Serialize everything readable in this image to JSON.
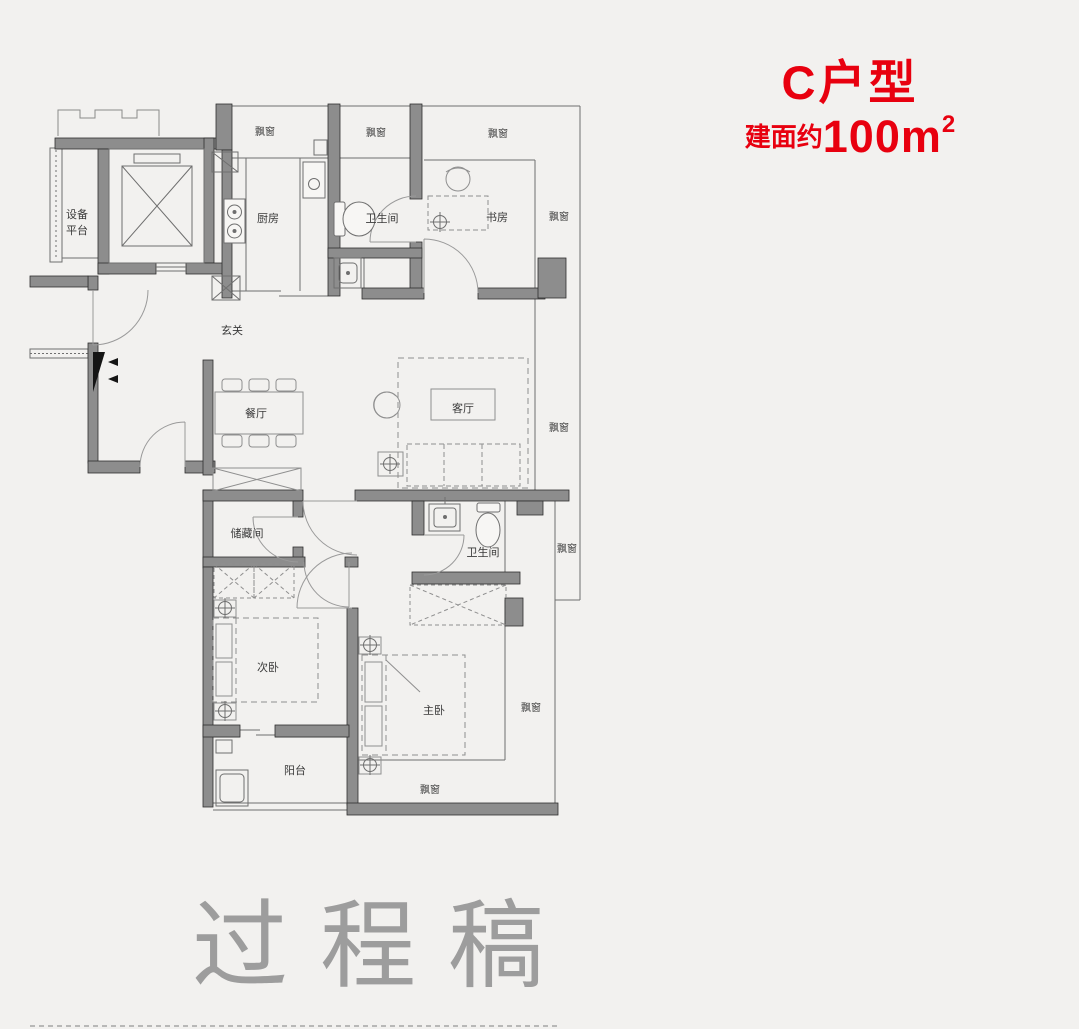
{
  "title": {
    "unit_type": "C户型",
    "area_prefix": "建面约",
    "area_value": "100m",
    "area_superscript": "2"
  },
  "watermark": {
    "text": "过程稿"
  },
  "rooms": {
    "equipment_platform_line1": "设备",
    "equipment_platform_line2": "平台",
    "kitchen": "厨房",
    "bathroom_upper": "卫生间",
    "study": "书房",
    "entrance": "玄关",
    "dining": "餐厅",
    "living": "客厅",
    "storage": "储藏间",
    "bathroom_lower": "卫生间",
    "second_bedroom": "次卧",
    "master_bedroom": "主卧",
    "balcony": "阳台",
    "bay_window": "飘窗"
  },
  "colors": {
    "accent_red": "#e8000f",
    "wall_fill": "#8d8d8d",
    "thin_line": "#6f6f6f",
    "label_text": "#3a3a3a",
    "watermark_gray": "#9d9d9d",
    "background": "#f2f1ef"
  }
}
